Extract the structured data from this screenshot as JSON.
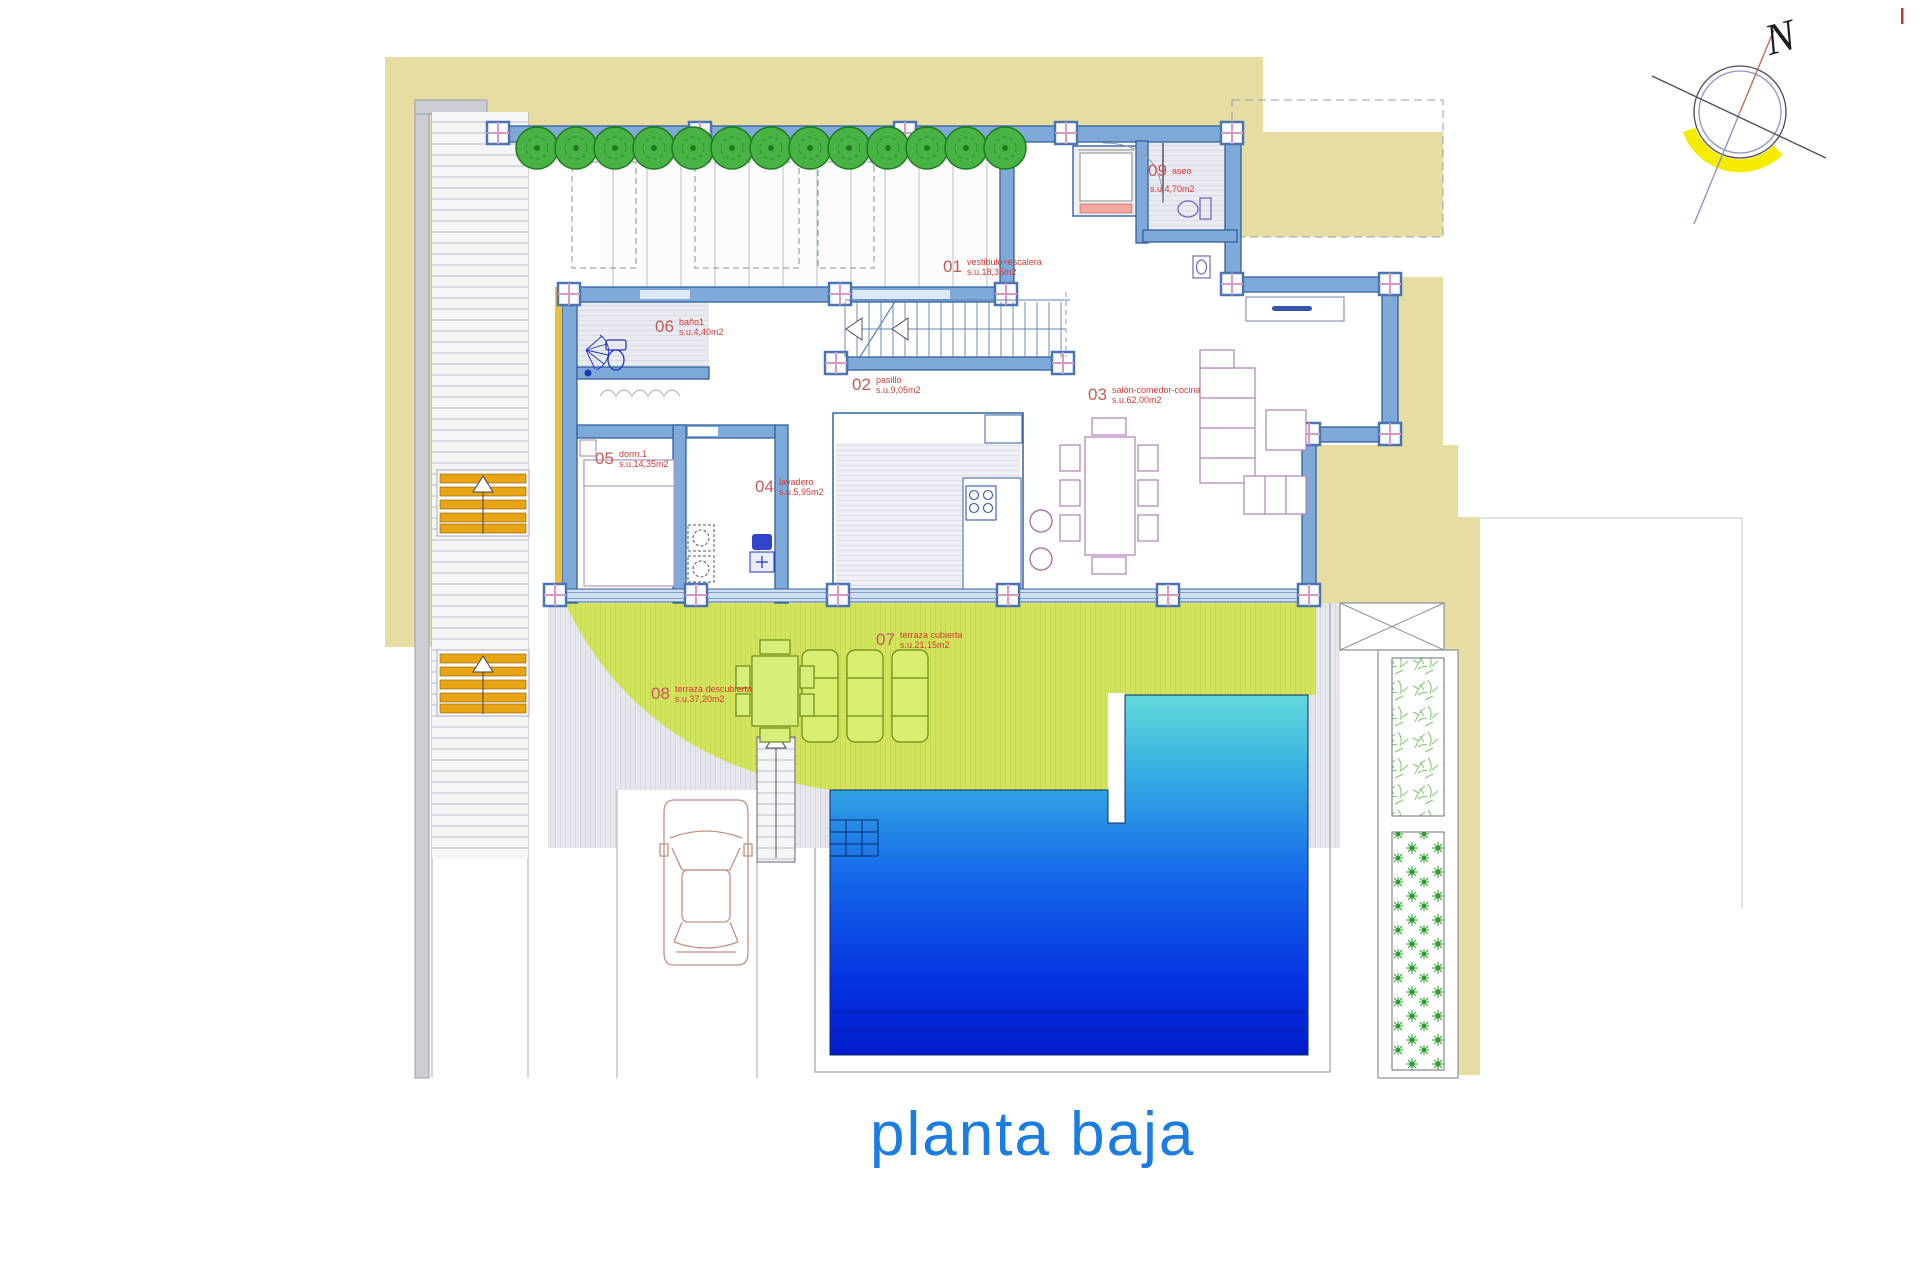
{
  "title": "planta baja",
  "compass": {
    "letter": "N"
  },
  "rooms": [
    {
      "num": "01",
      "name": "vestibulo+escalera",
      "area": "s.u.18,35m2"
    },
    {
      "num": "02",
      "name": "pasillo",
      "area": "s.u.9,05m2"
    },
    {
      "num": "03",
      "name": "salón-comedor-cocina",
      "area": "s.u.62,00m2"
    },
    {
      "num": "04",
      "name": "lavadero",
      "area": "s.u.5,95m2"
    },
    {
      "num": "05",
      "name": "dorm.1",
      "area": "s.u.14,35m2"
    },
    {
      "num": "06",
      "name": "baño1",
      "area": "s.u.4,40m2"
    },
    {
      "num": "07",
      "name": "terraza cubierta",
      "area": "s.u.21,15m2"
    },
    {
      "num": "08",
      "name": "terraza descubierta",
      "area": "s.u.37,20m2"
    },
    {
      "num": "09",
      "name": "aseo",
      "area": "s.u.4,70m2"
    }
  ],
  "colors": {
    "plot_tan": "#e6dda2",
    "wall_outline": "#33619f",
    "wall_fill": "#7fa9d8",
    "accent_pink": "#d898c8",
    "label_red": "#d43b35",
    "title_blue": "#1b7de2",
    "terrace_green": "#d2e35e",
    "pool_top": "#62d9da",
    "pool_bottom": "#021bcb",
    "stair_orange": "#e7a415",
    "tree_green": "#49b245"
  }
}
